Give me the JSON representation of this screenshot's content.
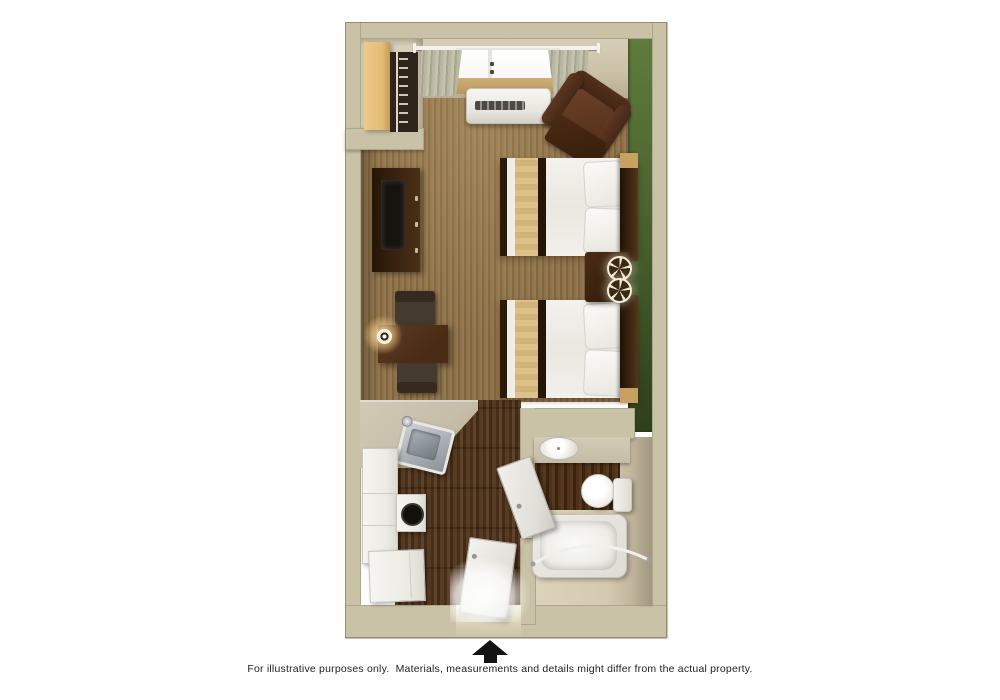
{
  "caption": {
    "text": "For illustrative purposes only.  Materials, measurements and details might differ from the actual property."
  },
  "entrance": {
    "symbol": "up-arrow",
    "color": "#121212"
  },
  "floorplan": {
    "type": "studio-suite-3d-top-down-floor-plan",
    "rooms": [
      {
        "name": "main-room",
        "floor": "brown-carpet",
        "accent_wall_color": "#4b6330"
      },
      {
        "name": "closet",
        "floor": "none"
      },
      {
        "name": "kitchenette",
        "floor": "dark-wood"
      },
      {
        "name": "entry",
        "floor": "dark-wood"
      },
      {
        "name": "bathroom",
        "floor": "beige-and-dark-wood"
      }
    ],
    "colors": {
      "wall": "#cac2a7",
      "carpet": "#8b6e44",
      "wood_floor": "#4e3118",
      "accent_wall": "#4b6330",
      "counter": "#c6bda9",
      "furniture_dark": "#3a2410",
      "armchair": "#53301c",
      "bedding_white": "#f1efe9",
      "bed_runner": "#d6ba80",
      "fixture_white": "#f2f1ed"
    },
    "furniture": [
      "closet-shelf",
      "closet-hanging-rod",
      "window",
      "curtains",
      "curtain-rod",
      "ac-unit",
      "armchair",
      "ottoman",
      "tv-console",
      "tv",
      "desk",
      "desk-chair-top",
      "desk-chair-bottom",
      "desk-lamp",
      "bed-1",
      "bed-2",
      "nightstand",
      "table-lamp-1",
      "table-lamp-2",
      "kitchen-counter",
      "kitchen-sink",
      "cooktop",
      "tall-cabinet",
      "lower-cabinet",
      "entry-door",
      "bathroom-door",
      "bathroom-vanity",
      "bathroom-sink",
      "toilet",
      "bathtub",
      "shower-curtain-rod"
    ]
  }
}
